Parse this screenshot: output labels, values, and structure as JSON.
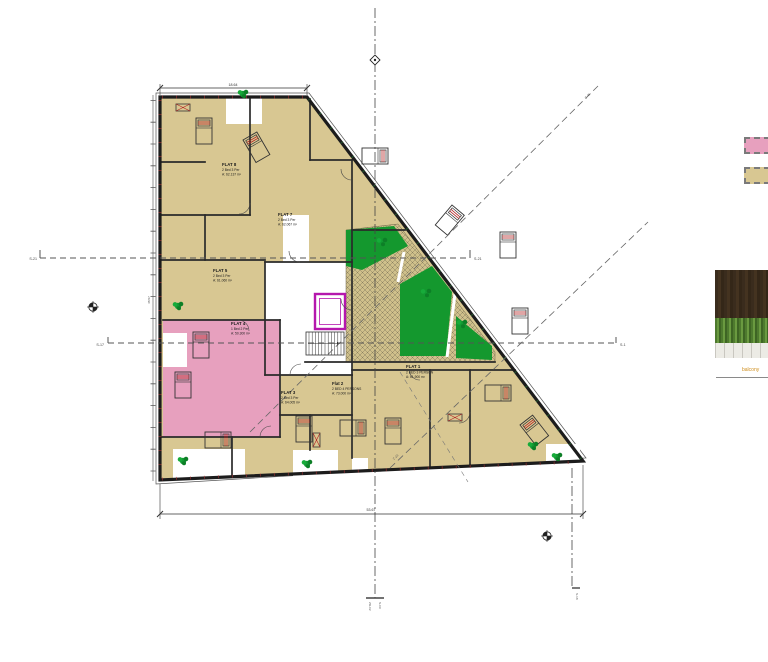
{
  "drawing_type": "architectural-floor-plan",
  "colors": {
    "flat_fill_tan": "#d8c792",
    "flat_fill_pink": "#e7a0be",
    "garden_green": "#14982e",
    "lift_magenta": "#b517ad",
    "wall": "#232323"
  },
  "flats": [
    {
      "id": "flat-1",
      "name": "FLAT 1",
      "occupancy": "2 BED 3 PERSON",
      "area": "A: 61.900 m²"
    },
    {
      "id": "flat-2",
      "name": "Flat 2",
      "occupancy": "2 BED 4 PERSONS",
      "area": "A: 73.000 m²"
    },
    {
      "id": "flat-3",
      "name": "FLAT 3",
      "occupancy": "2 Bed 3 Per",
      "area": "A: 64.005 m²"
    },
    {
      "id": "flat-4",
      "name": "FLAT 4",
      "occupancy": "1 Bed 2 Per",
      "area": "A: 50.300 m²"
    },
    {
      "id": "flat-5",
      "name": "FLAT 5",
      "occupancy": "2 Bed 3 Per",
      "area": "A: 61.060 m²"
    },
    {
      "id": "flat-7",
      "name": "FLAT 7",
      "occupancy": "2 Bed 3 Per",
      "area": "A: 62.067 m²"
    },
    {
      "id": "flat-8",
      "name": "FLAT 8",
      "occupancy": "2 Bed 3 Per",
      "area": "A: 62.137 m²"
    }
  ],
  "section_markers": {
    "s21_left": "S-21",
    "s21_right": "S-21",
    "s17": "S-17",
    "s1": "S-1"
  },
  "grid_markers": {
    "z45": "Z-45",
    "z23": "Z-23",
    "zd02": "ZD-02",
    "s09": "S-09",
    "s18": "S-18"
  },
  "dimensions": {
    "bottom": "53.67",
    "top": "18.64",
    "left": "48.57"
  },
  "photo": {
    "caption": "balcony"
  },
  "legend": {
    "pink_swatch_color": "#e7a0be",
    "tan_swatch_color": "#d8c792"
  }
}
